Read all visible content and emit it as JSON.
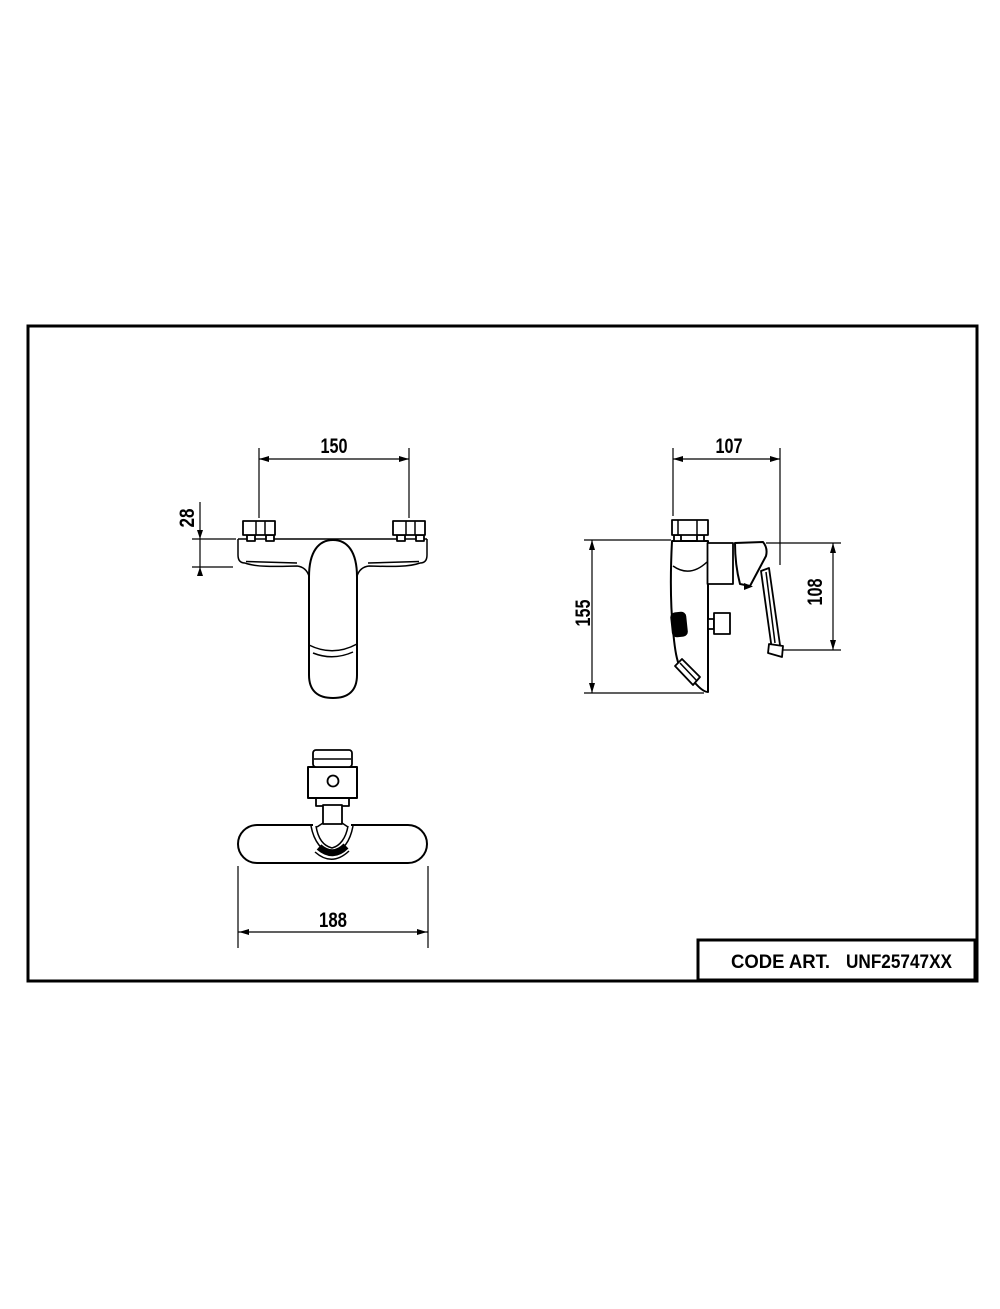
{
  "page": {
    "background_color": "#ffffff",
    "line_color": "#000000"
  },
  "views": {
    "front": {
      "hole_spacing_mm": "150",
      "body_height_mm": "28"
    },
    "side": {
      "depth_mm": "107",
      "total_height_mm": "155",
      "handle_height_mm": "108"
    },
    "bottom": {
      "body_width_mm": "188"
    }
  },
  "title_block": {
    "label": "CODE ART.",
    "code": "UNF25747XX"
  }
}
